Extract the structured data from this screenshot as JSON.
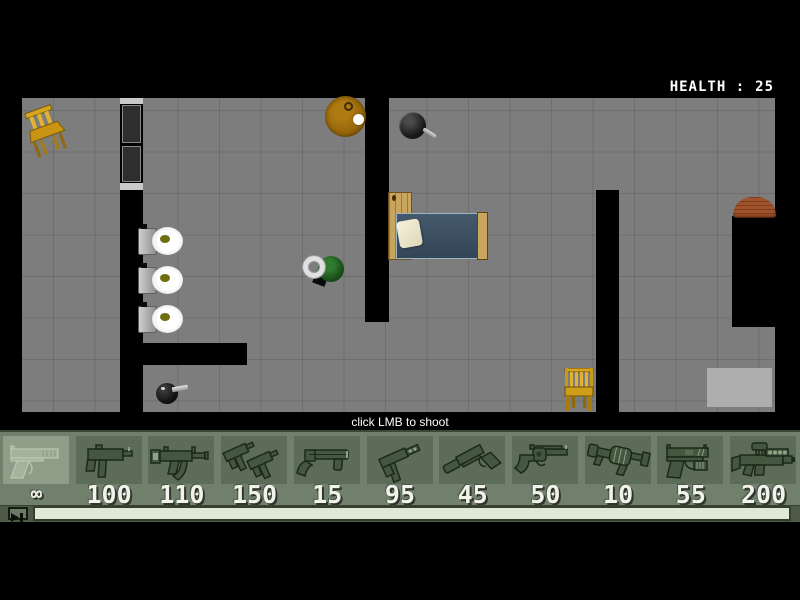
{
  "hud": {
    "health_label": "HEALTH :",
    "health_value": "25"
  },
  "hint": "click LMB to shoot",
  "weapon_bar": {
    "selected_index": 0,
    "slots": [
      {
        "weapon": "desert-eagle",
        "ammo": "∞"
      },
      {
        "weapon": "mac-10",
        "ammo": "100"
      },
      {
        "weapon": "mp5",
        "ammo": "110"
      },
      {
        "weapon": "dual-uzi",
        "ammo": "150"
      },
      {
        "weapon": "sawn-off-shotgun",
        "ammo": "15"
      },
      {
        "weapon": "tec-9",
        "ammo": "95"
      },
      {
        "weapon": "silenced-pistol",
        "ammo": "45"
      },
      {
        "weapon": "revolver",
        "ammo": "50"
      },
      {
        "weapon": "grenade-launcher",
        "ammo": "10"
      },
      {
        "weapon": "p99-pistol",
        "ammo": "55"
      },
      {
        "weapon": "scoped-rifle",
        "ammo": "200"
      }
    ]
  },
  "map_objects": [
    "chair",
    "round-table",
    "frying-pan",
    "bed",
    "toilet",
    "toilet",
    "toilet",
    "player-character",
    "pistol-pickup",
    "chair",
    "gray-rug",
    "brown-rug",
    "window-wall"
  ],
  "colors": {
    "floor": "#7d7d7d",
    "wall": "#000000",
    "bar_background": "#71806c",
    "tile": "#5d6c58",
    "tile_selected": "#8e9d87",
    "ammo_text": "#f2f2ec",
    "health_text": "#ffffff",
    "progress_bar_fill": "#dfe7d7",
    "chair_wood": "#d8a51e",
    "bed_blanket": "#3d5265",
    "toilet_seat_hole": "#6f6f12"
  }
}
